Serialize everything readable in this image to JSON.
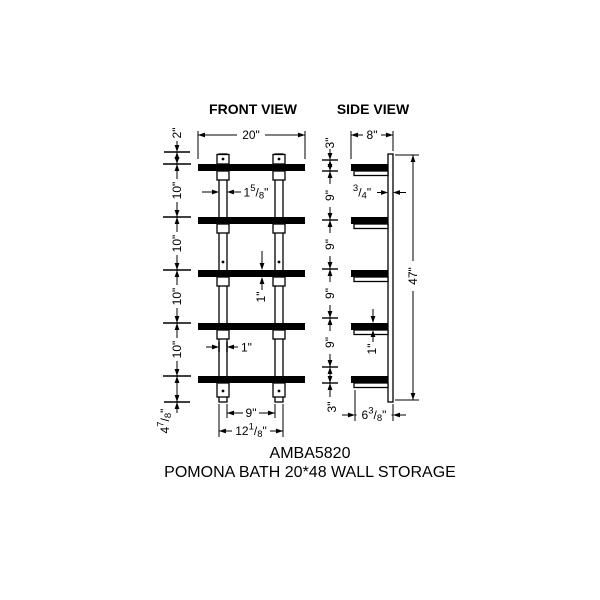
{
  "drawing": {
    "front": {
      "title": "FRONT VIEW",
      "width_label": "20\"",
      "top_offset_label": "2\"",
      "spacing_labels": [
        "10\"",
        "10\"",
        "10\"",
        "10\""
      ],
      "rail_width_label": {
        "whole": "1",
        "num": "5",
        "slash": "/",
        "den": "8",
        "unit": "\""
      },
      "shelf_thickness_label": "1\"",
      "rail_face_label": "1\"",
      "bottom_offset_label": {
        "whole": "4",
        "num": "7",
        "slash": "/",
        "den": "8",
        "unit": "\""
      },
      "inner_span_label": "9\"",
      "outer_span_label": {
        "whole": "12",
        "num": "1",
        "slash": "/",
        "den": "8",
        "unit": "\""
      }
    },
    "side": {
      "title": "SIDE VIEW",
      "depth_label": "8\"",
      "top_offset_label": "3\"",
      "panel_thickness_label": {
        "whole": "",
        "num": "3",
        "slash": "/",
        "den": "4",
        "unit": "\""
      },
      "spacing_labels": [
        "9\"",
        "9\"",
        "9\"",
        "9\""
      ],
      "shelf_thickness_label": "1\"",
      "overall_height_label": "47\"",
      "bottom_offset_label": "3\"",
      "bottom_depth_label": {
        "whole": "6",
        "num": "3",
        "slash": "/",
        "den": "8",
        "unit": "\""
      }
    },
    "footer": {
      "model": "AMBA5820",
      "product_name": "POMONA BATH 20*48 WALL STORAGE"
    },
    "colors": {
      "ink": "#000000",
      "paper": "#ffffff"
    }
  }
}
